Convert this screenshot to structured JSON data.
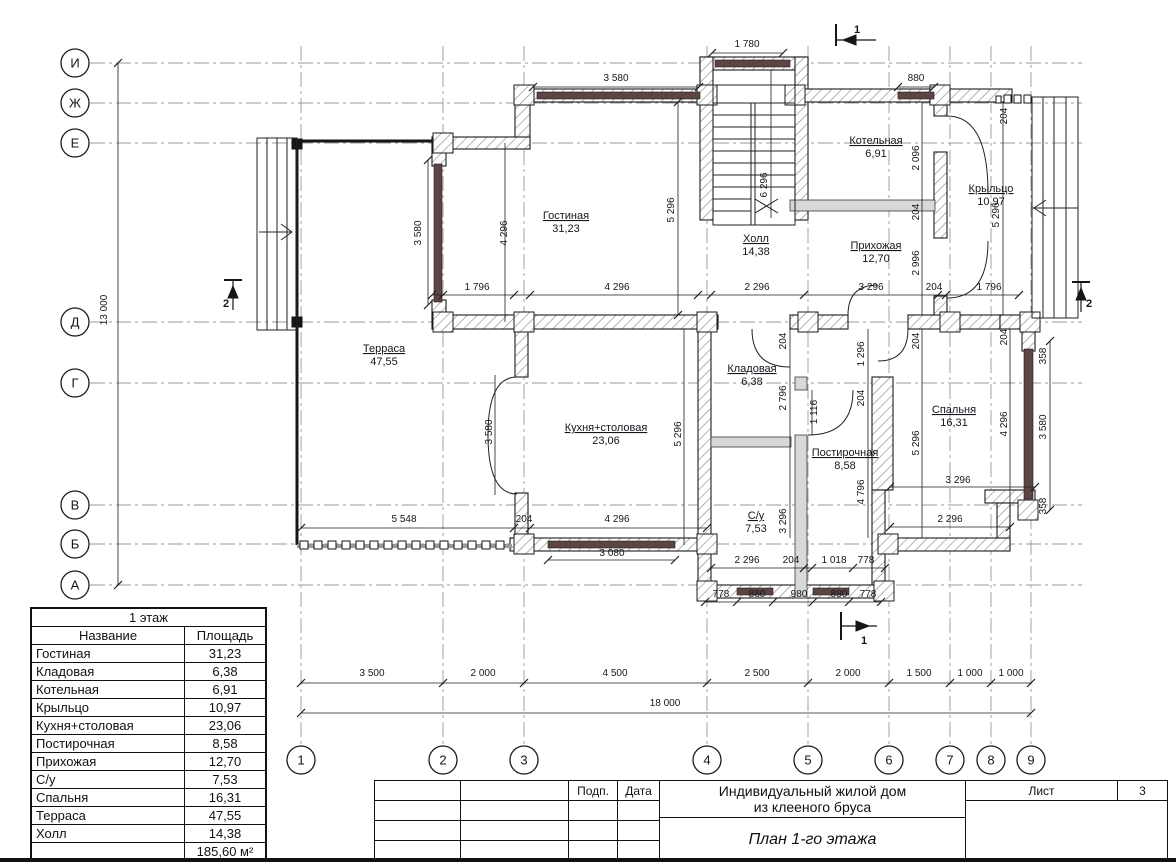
{
  "titleblock": {
    "podp": "Подп.",
    "data": "Дата",
    "title_line1": "Индивидуальный жилой дом",
    "title_line2": "из клееного бруса",
    "subtitle": "План 1-го этажа",
    "sheet_label": "Лист",
    "sheet_number": "3"
  },
  "legend": {
    "title": "1 этаж",
    "col_name": "Название",
    "col_area": "Площадь",
    "rows": [
      {
        "name": "Гостиная",
        "area": "31,23"
      },
      {
        "name": "Кладовая",
        "area": "6,38"
      },
      {
        "name": "Котельная",
        "area": "6,91"
      },
      {
        "name": "Крыльцо",
        "area": "10,97"
      },
      {
        "name": "Кухня+столовая",
        "area": "23,06"
      },
      {
        "name": "Постирочная",
        "area": "8,58"
      },
      {
        "name": "Прихожая",
        "area": "12,70"
      },
      {
        "name": "С/у",
        "area": "7,53"
      },
      {
        "name": "Спальня",
        "area": "16,31"
      },
      {
        "name": "Терраса",
        "area": "47,55"
      },
      {
        "name": "Холл",
        "area": "14,38"
      }
    ],
    "total": "185,60 м²"
  },
  "plan": {
    "colors": {
      "window": "#5b4545",
      "partition": "#d8d8d8",
      "axis_line": "#9a9a9a"
    },
    "axes_rows": [
      {
        "label": "И",
        "y": 63
      },
      {
        "label": "Ж",
        "y": 103
      },
      {
        "label": "Е",
        "y": 143
      },
      {
        "label": "Д",
        "y": 322
      },
      {
        "label": "Г",
        "y": 383
      },
      {
        "label": "В",
        "y": 505
      },
      {
        "label": "Б",
        "y": 544
      },
      {
        "label": "А",
        "y": 585
      }
    ],
    "axes_cols": [
      {
        "label": "1",
        "x": 301
      },
      {
        "label": "2",
        "x": 443
      },
      {
        "label": "3",
        "x": 524
      },
      {
        "label": "4",
        "x": 707
      },
      {
        "label": "5",
        "x": 808
      },
      {
        "label": "6",
        "x": 889
      },
      {
        "label": "7",
        "x": 950
      },
      {
        "label": "8",
        "x": 991
      },
      {
        "label": "9",
        "x": 1031
      }
    ],
    "rooms": [
      {
        "name": "Гостиная",
        "area": "31,23",
        "x": 566,
        "y": 219
      },
      {
        "name": "Холл",
        "area": "14,38",
        "x": 756,
        "y": 242
      },
      {
        "name": "Прихожая",
        "area": "12,70",
        "x": 876,
        "y": 249
      },
      {
        "name": "Котельная",
        "area": "6,91",
        "x": 876,
        "y": 144
      },
      {
        "name": "Крыльцо",
        "area": "10,97",
        "x": 991,
        "y": 192
      },
      {
        "name": "Терраса",
        "area": "47,55",
        "x": 384,
        "y": 352
      },
      {
        "name": "Кухня+столовая",
        "area": "23,06",
        "x": 606,
        "y": 431
      },
      {
        "name": "Кладовая",
        "area": "6,38",
        "x": 752,
        "y": 372
      },
      {
        "name": "Постирочная",
        "area": "8,58",
        "x": 845,
        "y": 456
      },
      {
        "name": "С/у",
        "area": "7,53",
        "x": 756,
        "y": 519
      },
      {
        "name": "Спальня",
        "area": "16,31",
        "x": 954,
        "y": 413
      }
    ],
    "dims": [
      {
        "t": "1 780",
        "x": 747,
        "y": 47
      },
      {
        "t": "3 580",
        "x": 616,
        "y": 81
      },
      {
        "t": "880",
        "x": 916,
        "y": 81
      },
      {
        "t": "1 796",
        "x": 477,
        "y": 290
      },
      {
        "t": "4 296",
        "x": 617,
        "y": 290
      },
      {
        "t": "2 296",
        "x": 757,
        "y": 290
      },
      {
        "t": "3 296",
        "x": 871,
        "y": 290
      },
      {
        "t": "204",
        "x": 934,
        "y": 290
      },
      {
        "t": "1 796",
        "x": 989,
        "y": 290
      },
      {
        "t": "5 548",
        "x": 404,
        "y": 522
      },
      {
        "t": "204",
        "x": 524,
        "y": 522
      },
      {
        "t": "4 296",
        "x": 617,
        "y": 522
      },
      {
        "t": "3 080",
        "x": 612,
        "y": 556
      },
      {
        "t": "3 296",
        "x": 958,
        "y": 483
      },
      {
        "t": "2 296",
        "x": 950,
        "y": 522
      },
      {
        "t": "2 296",
        "x": 747,
        "y": 563
      },
      {
        "t": "204",
        "x": 791,
        "y": 563
      },
      {
        "t": "1 018",
        "x": 834,
        "y": 563
      },
      {
        "t": "778",
        "x": 866,
        "y": 563
      },
      {
        "t": "778",
        "x": 721,
        "y": 597
      },
      {
        "t": "880",
        "x": 757,
        "y": 597
      },
      {
        "t": "980",
        "x": 799,
        "y": 597
      },
      {
        "t": "880",
        "x": 839,
        "y": 597
      },
      {
        "t": "778",
        "x": 868,
        "y": 597
      },
      {
        "t": "3 500",
        "x": 372,
        "y": 676
      },
      {
        "t": "2 000",
        "x": 483,
        "y": 676
      },
      {
        "t": "4 500",
        "x": 615,
        "y": 676
      },
      {
        "t": "2 500",
        "x": 757,
        "y": 676
      },
      {
        "t": "2 000",
        "x": 848,
        "y": 676
      },
      {
        "t": "1 500",
        "x": 919,
        "y": 676
      },
      {
        "t": "1 000",
        "x": 970,
        "y": 676
      },
      {
        "t": "1 000",
        "x": 1011,
        "y": 676
      },
      {
        "t": "18 000",
        "x": 665,
        "y": 706
      },
      {
        "t": "13 000",
        "x": 107,
        "y": 310,
        "r": -90
      },
      {
        "t": "3 580",
        "x": 421,
        "y": 233,
        "r": -90
      },
      {
        "t": "4 296",
        "x": 507,
        "y": 233,
        "r": -90
      },
      {
        "t": "5 296",
        "x": 674,
        "y": 210,
        "r": -90
      },
      {
        "t": "6 296",
        "x": 767,
        "y": 185,
        "r": -90
      },
      {
        "t": "204",
        "x": 1007,
        "y": 116,
        "r": -90
      },
      {
        "t": "2 096",
        "x": 919,
        "y": 158,
        "r": -90
      },
      {
        "t": "204",
        "x": 919,
        "y": 212,
        "r": -90
      },
      {
        "t": "2 996",
        "x": 919,
        "y": 263,
        "r": -90
      },
      {
        "t": "5 296",
        "x": 999,
        "y": 215,
        "r": -90
      },
      {
        "t": "204",
        "x": 786,
        "y": 341,
        "r": -90
      },
      {
        "t": "1 296",
        "x": 864,
        "y": 354,
        "r": -90
      },
      {
        "t": "204",
        "x": 919,
        "y": 341,
        "r": -90
      },
      {
        "t": "2 796",
        "x": 786,
        "y": 398,
        "r": -90
      },
      {
        "t": "1 116",
        "x": 817,
        "y": 412,
        "r": -90
      },
      {
        "t": "204",
        "x": 864,
        "y": 398,
        "r": -90
      },
      {
        "t": "5 296",
        "x": 919,
        "y": 443,
        "r": -90
      },
      {
        "t": "4 796",
        "x": 864,
        "y": 492,
        "r": -90
      },
      {
        "t": "3 296",
        "x": 786,
        "y": 521,
        "r": -90
      },
      {
        "t": "3 580",
        "x": 492,
        "y": 432,
        "r": -90
      },
      {
        "t": "5 296",
        "x": 681,
        "y": 434,
        "r": -90
      },
      {
        "t": "204",
        "x": 1007,
        "y": 337,
        "r": -90
      },
      {
        "t": "4 296",
        "x": 1007,
        "y": 424,
        "r": -90
      },
      {
        "t": "358",
        "x": 1046,
        "y": 356,
        "r": -90
      },
      {
        "t": "3 580",
        "x": 1046,
        "y": 427,
        "r": -90
      },
      {
        "t": "358",
        "x": 1046,
        "y": 506,
        "r": -90
      }
    ],
    "sections": [
      {
        "t": "1",
        "x": 857,
        "y": 33
      },
      {
        "t": "1",
        "x": 864,
        "y": 644
      },
      {
        "t": "2",
        "x": 226,
        "y": 307
      },
      {
        "t": "2",
        "x": 1089,
        "y": 307
      }
    ]
  }
}
